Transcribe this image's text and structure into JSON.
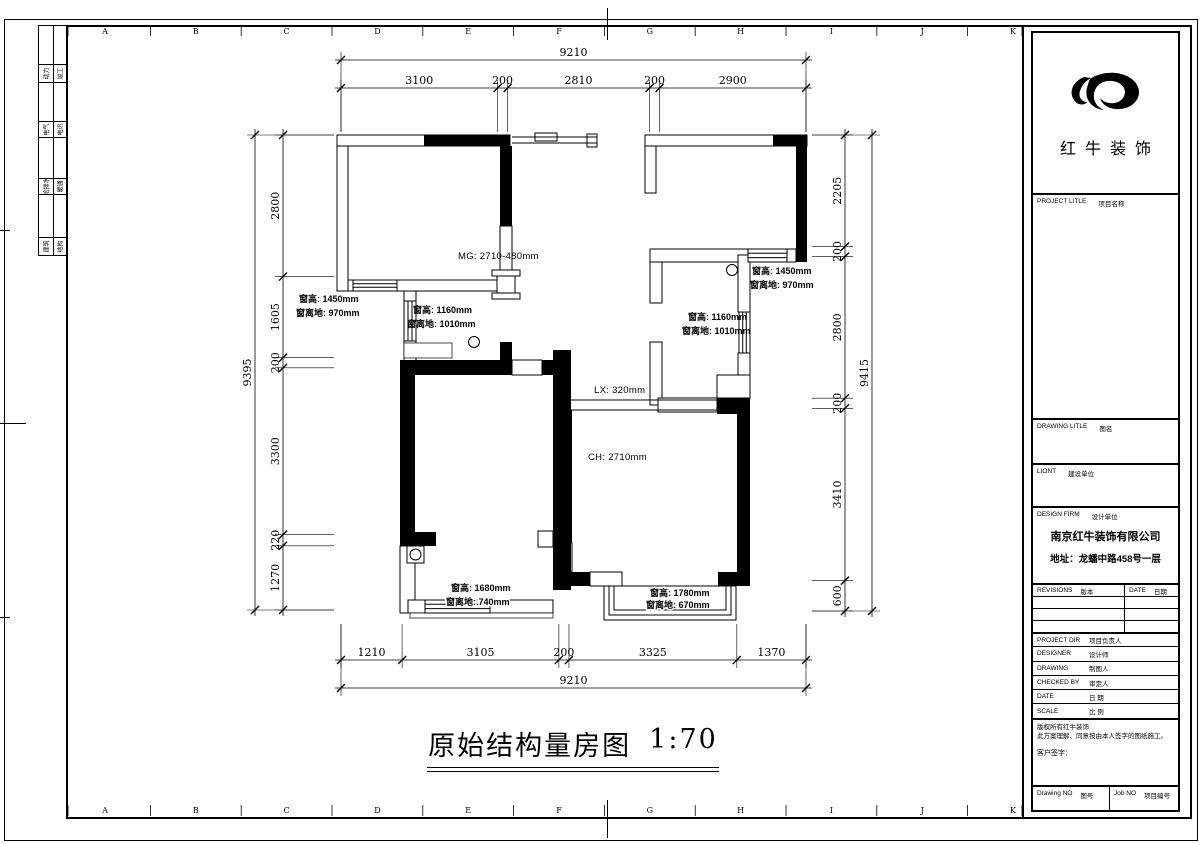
{
  "sheet": {
    "ruler_letters": [
      "A",
      "B",
      "C",
      "D",
      "E",
      "F",
      "G",
      "H",
      "I",
      "J",
      "K"
    ],
    "edge_strip_rows": [
      {
        "left": "动力",
        "right": "竣工"
      },
      {
        "left": "电气",
        "right": "电讯"
      },
      {
        "left": "给排水",
        "right": "暖通"
      },
      {
        "left": "建筑",
        "right": "结构"
      }
    ]
  },
  "drawing_title": {
    "text": "原始结构量房图",
    "scale": "1:70"
  },
  "dimensions": {
    "top_total": "9210",
    "top_segments": [
      "3100",
      "200",
      "2810",
      "200",
      "2900"
    ],
    "bottom_segments": [
      "1210",
      "3105",
      "200",
      "3325",
      "1370"
    ],
    "bottom_total": "9210",
    "left_total": "9395",
    "left_segments": [
      "2800",
      "1605",
      "200",
      "3300",
      "220",
      "1270"
    ],
    "right_segments": [
      "2205",
      "200",
      "2800",
      "200",
      "3410",
      "600"
    ],
    "right_total": "9415"
  },
  "annotations": {
    "mg": "MG: 2710-480mm",
    "lx": "LX: 320mm",
    "ch": "CH: 2710mm",
    "win_left": {
      "l1": "窗高: 1450mm",
      "l2": "窗离地: 970mm"
    },
    "win_hall": {
      "l1": "窗高: 1160mm",
      "l2": "窗离地: 1010mm"
    },
    "win_right": {
      "l1": "窗高: 1450mm",
      "l2": "窗离地: 970mm"
    },
    "win_mid_right": {
      "l1": "窗高: 1160mm",
      "l2": "窗离地: 1010mm"
    },
    "win_bottom_left": {
      "l1": "窗高: 1680mm",
      "l2": "窗离地: 740mm"
    },
    "win_bottom_right": {
      "l1": "窗高: 1780mm",
      "l2": "窗离地: 670mm"
    }
  },
  "title_block": {
    "logo_text": "红牛装饰",
    "project_label": {
      "en": "PROJECT LITLE",
      "cn": "项目名称"
    },
    "drawing_label": {
      "en": "DRAWING LITLE",
      "cn": "图名"
    },
    "client_label": {
      "en": "LIONT",
      "cn": "建设单位"
    },
    "design_firm_label": {
      "en": "DESIGN FIRM",
      "cn": "设计单位"
    },
    "firm_name": "南京红牛装饰有限公司",
    "firm_address": "地址：龙蟠中路458号一层",
    "revisions_label": {
      "en": "REVISIONS",
      "cn": "版本"
    },
    "date_col_label": {
      "en": "DATE",
      "cn": "日期"
    },
    "rows": [
      {
        "en": "PROJECT DIR",
        "cn": "项目负责人"
      },
      {
        "en": "DESIGNER",
        "cn": "设计师"
      },
      {
        "en": "DRAWING",
        "cn": "制图人"
      },
      {
        "en": "CHECKED BY",
        "cn": "审定人"
      },
      {
        "en": "DATE",
        "cn": "日 期"
      },
      {
        "en": "SCALE",
        "cn": "比 例"
      }
    ],
    "copyright_line1": "版权所有红牛装饰",
    "copyright_line2": "此方案理解、同意按由本人签字的图纸施工。",
    "signature": "客户签字：",
    "drawing_no_label": {
      "en": "Drawing NO",
      "cn": "图号"
    },
    "job_no_label": {
      "en": "Job NO",
      "cn": "项目编号"
    }
  }
}
